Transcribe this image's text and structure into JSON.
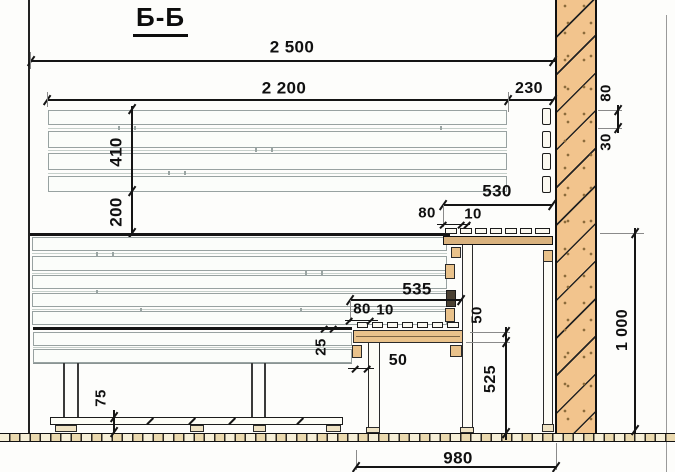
{
  "title": "Б-Б",
  "dims": {
    "overall_width": "2 500",
    "backrest_length": "2 200",
    "wall_offset": "230",
    "backrest_height": "410",
    "backrest_to_bench": "200",
    "wall_board_width": "80",
    "wall_board_gap": "30",
    "upper_shelf_depth": "530",
    "upper_shelf_overhang": "80",
    "upper_shelf_joint_gap": "10",
    "mid_shelf_depth": "535",
    "mid_shelf_overhang": "80",
    "mid_shelf_joint_gap": "10",
    "front_board_thickness": "25",
    "support_width": "50",
    "shelf_board_height": "50",
    "mid_shelf_height": "525",
    "floor_rail_height": "75",
    "floor_span": "980",
    "upper_shelf_height": "1 000"
  }
}
